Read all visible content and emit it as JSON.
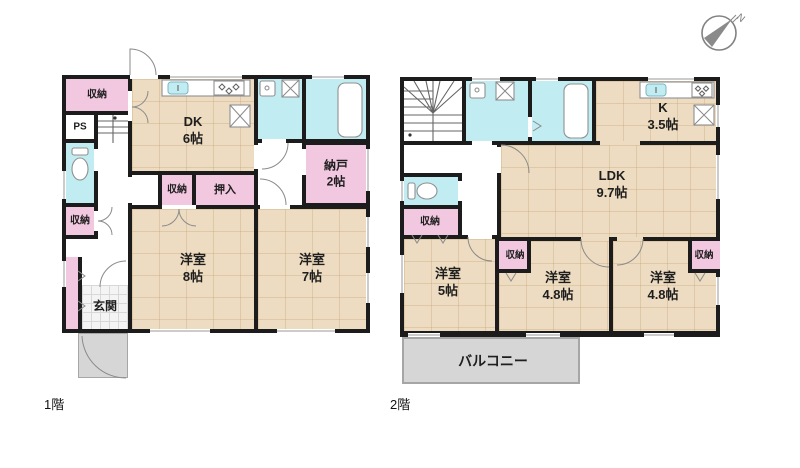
{
  "page": {
    "floor1_title": "1階",
    "floor2_title": "2階"
  },
  "compass": {
    "n": "N"
  },
  "colors": {
    "wall": "#1c1c1c",
    "wood": "#eddcc1",
    "pink": "#f2c7e0",
    "cyan": "#c0ecf2",
    "gray": "#d6d6d6"
  },
  "floor1": {
    "label": "1階",
    "rooms": {
      "closet_top": "収納",
      "ps": "PS",
      "closet_hall": "収納",
      "genkan": "玄関",
      "dk": {
        "name": "DK",
        "size": "6帖"
      },
      "closet_mid": "収納",
      "oshiire": "押入",
      "nando": {
        "name": "納戸",
        "size": "2帖"
      },
      "yoshitsu8": {
        "name": "洋室",
        "size": "8帖"
      },
      "yoshitsu7": {
        "name": "洋室",
        "size": "7帖"
      }
    }
  },
  "floor2": {
    "label": "2階",
    "rooms": {
      "k": {
        "name": "K",
        "size": "3.5帖"
      },
      "ldk": {
        "name": "LDK",
        "size": "9.7帖"
      },
      "closet_hall": "収納",
      "closet_mid": "収納",
      "closet_right": "収納",
      "yoshitsu5": {
        "name": "洋室",
        "size": "5帖"
      },
      "yoshitsu48a": {
        "name": "洋室",
        "size": "4.8帖"
      },
      "yoshitsu48b": {
        "name": "洋室",
        "size": "4.8帖"
      },
      "balcony": "バルコニー"
    }
  }
}
